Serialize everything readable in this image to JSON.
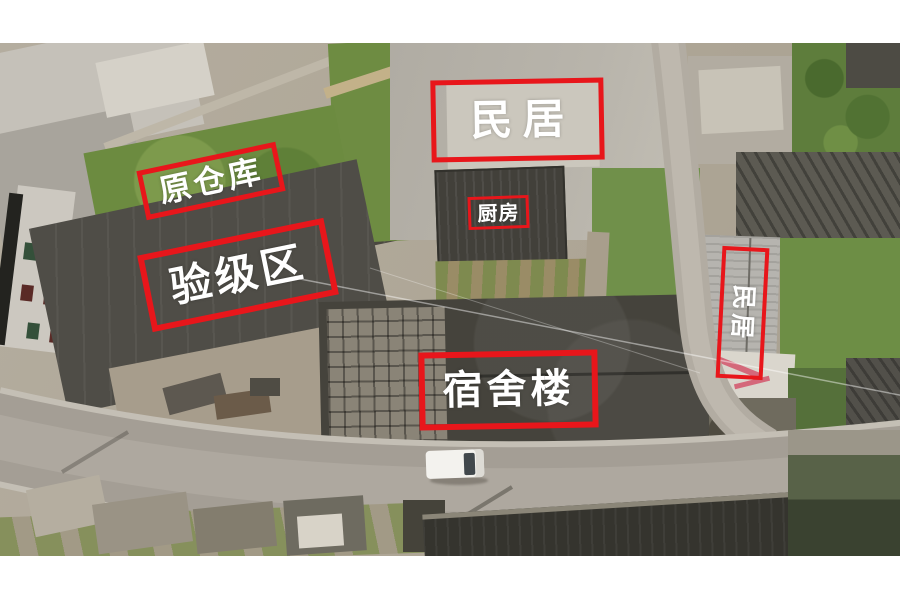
{
  "figure": {
    "kind": "annotated aerial drone photograph",
    "scene": "village buildings, grass plots, curved asphalt road with a white van"
  },
  "annotations": [
    {
      "id": "residence-top",
      "label": "民居",
      "orientation": "horizontal"
    },
    {
      "id": "former-warehouse",
      "label": "原仓库",
      "orientation": "horizontal"
    },
    {
      "id": "grading-area",
      "label": "验级区",
      "orientation": "horizontal"
    },
    {
      "id": "kitchen",
      "label": "厨房",
      "orientation": "horizontal"
    },
    {
      "id": "dormitory-building",
      "label": "宿舍楼",
      "orientation": "horizontal"
    },
    {
      "id": "residence-right",
      "label": "民居",
      "orientation": "vertical"
    }
  ],
  "colors": {
    "annotation_box": "#e8161b",
    "annotation_text": "#ffffff",
    "page_background": "#ffffff"
  }
}
